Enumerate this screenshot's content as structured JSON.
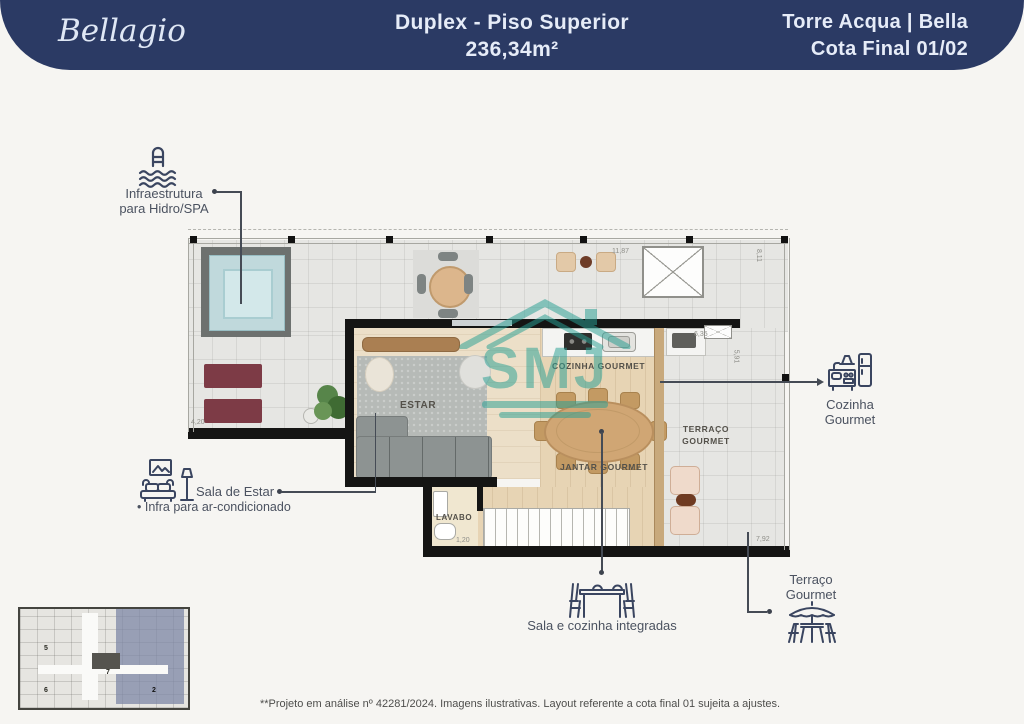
{
  "header": {
    "brand": "Bellagio",
    "title_line1": "Duplex - Piso Superior",
    "title_line2": "236,34m²",
    "right_line1": "Torre Acqua | Bella",
    "right_line2": "Cota Final 01/02",
    "bg_color": "#2b3a64",
    "text_color": "#e6ecf8"
  },
  "callouts": {
    "hidro": {
      "line1": "Infraestrutura",
      "line2": "para Hidro/SPA",
      "icon": "pool-ladder-icon"
    },
    "sala": {
      "label": "Sala de Estar",
      "bullet": "• Infra para ar-condicionado",
      "icon": "sofa-lamp-icon"
    },
    "cozinha": {
      "line1": "Cozinha",
      "line2": "Gourmet",
      "icon": "kitchen-icon"
    },
    "terraco": {
      "line1": "Terraço",
      "line2": "Gourmet",
      "icon": "patio-umbrella-icon"
    },
    "integradas": {
      "label": "Sala e cozinha integradas",
      "icon": "dining-table-icon"
    }
  },
  "plan": {
    "rooms": {
      "estar": "ESTAR",
      "cozinha": "COZINHA GOURMET",
      "jantar": "JANTAR GOURMET",
      "terraco_l1": "TERRAÇO",
      "terraco_l2": "GOURMET",
      "lavabo": "LAVABO"
    },
    "dimensions": {
      "top": "11,87",
      "right": "8,11",
      "kitchen": "6,35",
      "kitchen_side": "5,91",
      "bottom_right": "7,92",
      "terrace_left": "4,20",
      "lavabo": "1,20"
    }
  },
  "watermark": {
    "text": "SMJ",
    "color": "#2aa094"
  },
  "key_plan": {
    "units": [
      "5",
      "6",
      "7",
      "2"
    ]
  },
  "footer": {
    "disclaimer": "**Projeto em análise nº 42281/2024. Imagens ilustrativas. Layout referente a cota final 01 sujeita a ajustes."
  }
}
